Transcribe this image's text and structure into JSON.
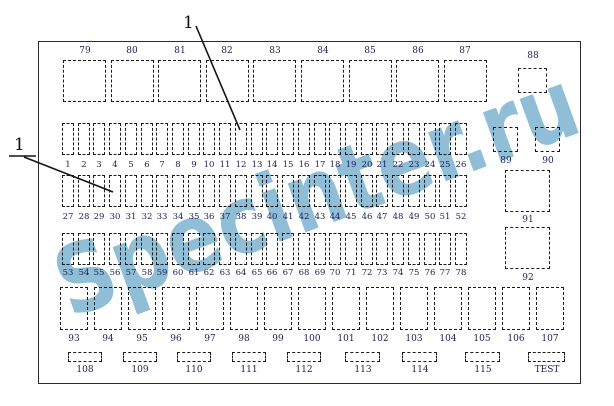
{
  "watermark": {
    "text": "Specinter.ru",
    "color": "#85b8d3"
  },
  "annotations": {
    "top_callout_label": "1",
    "left_callout_label": "1"
  },
  "relay_boxes_top": {
    "labels": [
      "79",
      "80",
      "81",
      "82",
      "83",
      "84",
      "85",
      "86",
      "87"
    ]
  },
  "relay_box_88": {
    "label": "88"
  },
  "fuse_rows": [
    [
      "1",
      "2",
      "3",
      "4",
      "5",
      "6",
      "7",
      "8",
      "9",
      "10",
      "11",
      "12",
      "13",
      "14",
      "15",
      "16",
      "17",
      "18",
      "19",
      "20",
      "21",
      "22",
      "23",
      "24",
      "25",
      "26"
    ],
    [
      "27",
      "28",
      "29",
      "30",
      "31",
      "32",
      "33",
      "34",
      "35",
      "36",
      "37",
      "38",
      "39",
      "40",
      "41",
      "42",
      "43",
      "44",
      "45",
      "46",
      "47",
      "48",
      "49",
      "50",
      "51",
      "52"
    ],
    [
      "53",
      "54",
      "55",
      "56",
      "57",
      "58",
      "59",
      "60",
      "61",
      "62",
      "63",
      "64",
      "65",
      "66",
      "67",
      "68",
      "69",
      "70",
      "71",
      "72",
      "73",
      "74",
      "75",
      "76",
      "77",
      "78"
    ]
  ],
  "side_boxes": {
    "labels": [
      "89",
      "90",
      "91",
      "92"
    ]
  },
  "bottom_boxes": {
    "labels": [
      "93",
      "94",
      "95",
      "96",
      "97",
      "98",
      "99",
      "100",
      "101",
      "102",
      "103",
      "104",
      "105",
      "106",
      "107"
    ]
  },
  "bottom_connectors": {
    "labels": [
      "108",
      "109",
      "110",
      "111",
      "112",
      "113",
      "114",
      "115",
      "TEST"
    ]
  }
}
